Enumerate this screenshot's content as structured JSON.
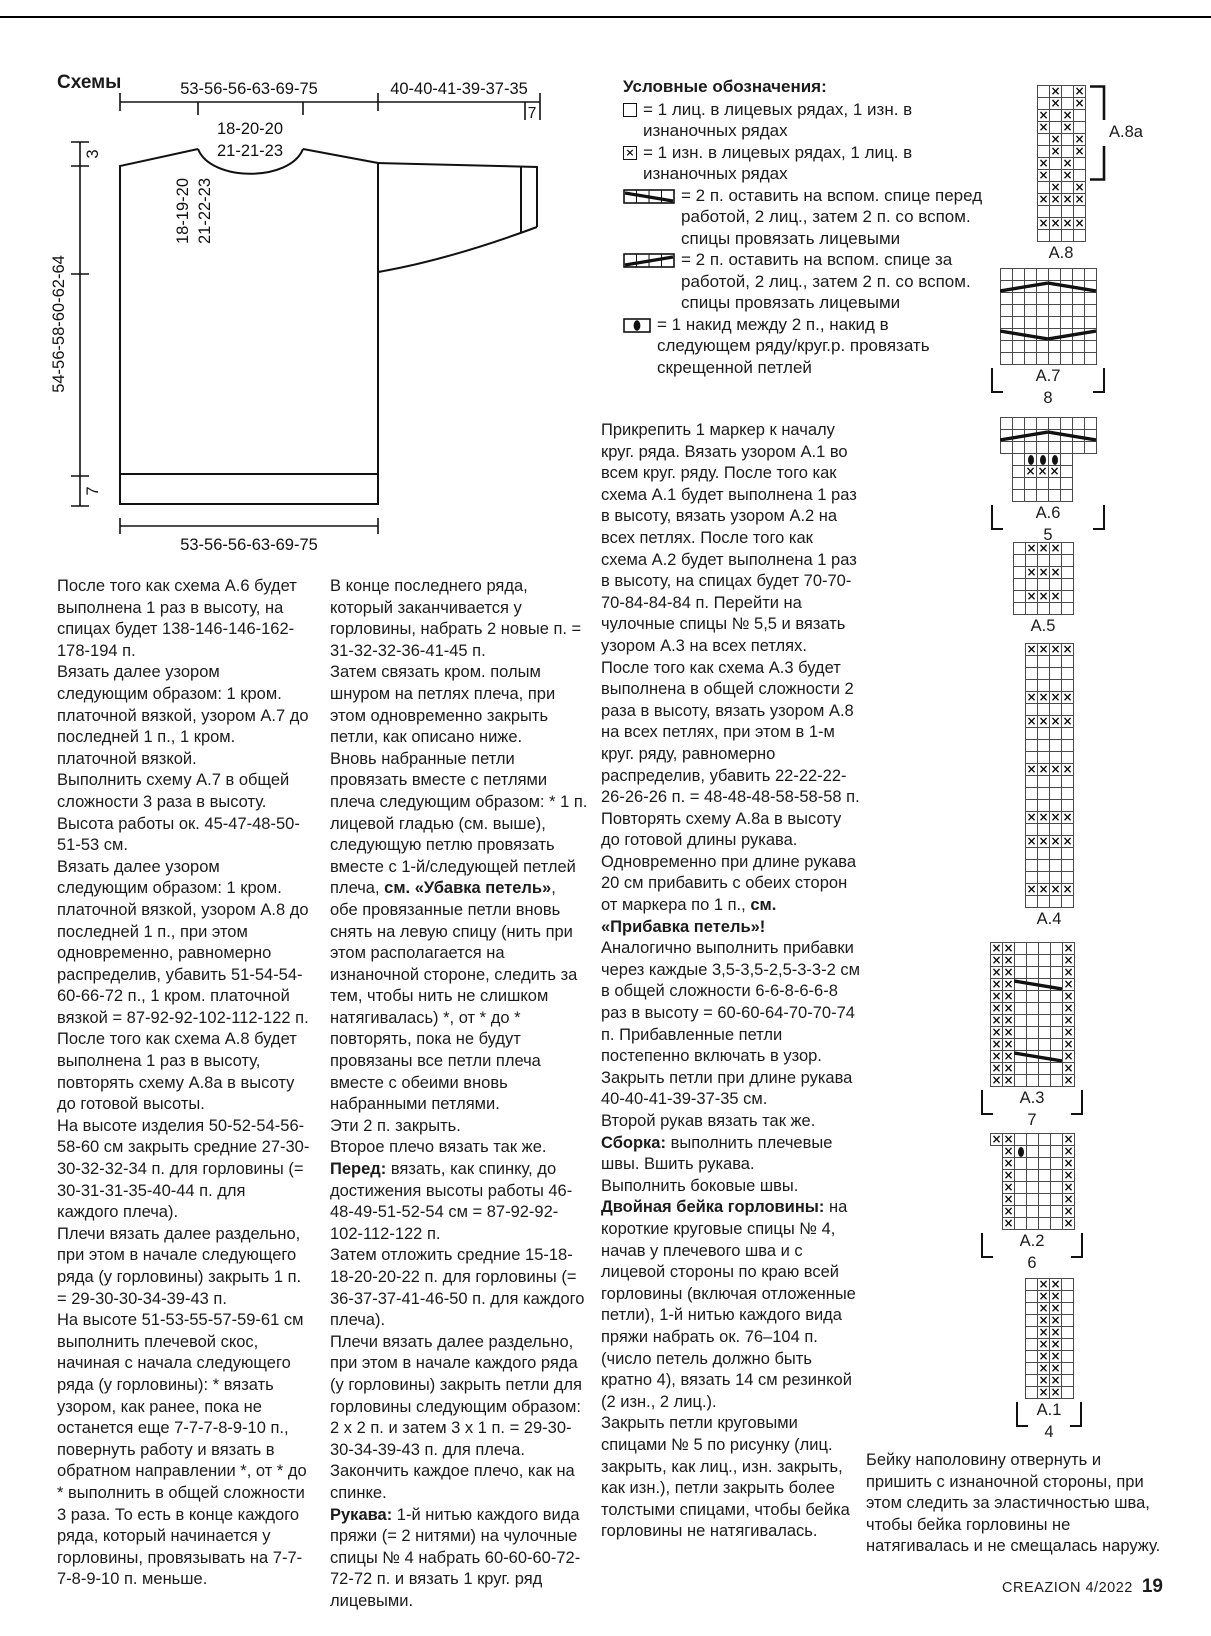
{
  "page": {
    "heading": "Схемы",
    "footer_magazine": "CREAZION 4/2022",
    "footer_page": "19"
  },
  "schematic": {
    "top_width": "53-56-56-63-69-75",
    "sleeve_length": "40-40-41-39-37-35",
    "cuff_width": "7",
    "neck_line1": "18-20-20",
    "neck_line2": "21-21-23",
    "shoulder_drop": "3",
    "yoke_line1": "18-19-20",
    "yoke_line2": "21-22-23",
    "side_height": "54-56-58-60-62-64",
    "rib_height": "7",
    "bottom_width": "53-56-56-63-69-75"
  },
  "legend": {
    "title": "Условные обозначения:",
    "items": [
      {
        "symbol": "knit-square",
        "text": "= 1 лиц. в лицевых рядах, 1 изн. в изнаночных рядах"
      },
      {
        "symbol": "purl-square-x",
        "text": "= 1 изн. в лицевых рядах, 1 лиц. в изнаночных рядах"
      },
      {
        "symbol": "cable-front-4",
        "text": "= 2 п. оставить на вспом. спице перед работой, 2 лиц., затем 2 п. со вспом. спицы провязать лицевыми"
      },
      {
        "symbol": "cable-back-4",
        "text": "= 2 п. оставить на вспом. спице за работой, 2 лиц., затем 2 п. со вспом. спицы провязать лицевыми"
      },
      {
        "symbol": "yarn-over-oval",
        "text": "= 1 накид между 2 п., накид в следующем ряду/круг.р. провязать скрещенной петлей"
      }
    ]
  },
  "charts": [
    {
      "id": "A.8",
      "cols": 4,
      "label": "A.8",
      "num": "",
      "bracket": false,
      "rows": [
        ".x.x",
        ".x.x",
        "x.x.",
        "x.x.",
        ".x.x",
        ".x.x",
        "x.x.",
        "x.x.",
        ".x.x",
        "xxxx",
        "....",
        "xxxx",
        "...."
      ],
      "cables": [],
      "rbracket": {
        "label": "A.8a",
        "from": 1,
        "to": 8
      }
    },
    {
      "id": "A.7",
      "cols": 8,
      "label": "A.7",
      "num": "8",
      "bracket": true,
      "rows": [
        "........",
        "........",
        "........",
        "........",
        "........",
        "........",
        "........",
        "........"
      ],
      "cables": [
        {
          "r": 2,
          "c1": 1,
          "c2": 4,
          "dir": "up"
        },
        {
          "r": 2,
          "c1": 5,
          "c2": 8,
          "dir": "down"
        },
        {
          "r": 6,
          "c1": 1,
          "c2": 4,
          "dir": "down"
        },
        {
          "r": 6,
          "c1": 5,
          "c2": 8,
          "dir": "up"
        }
      ]
    },
    {
      "id": "A.6",
      "cols": 8,
      "label": "A.6",
      "num": "5",
      "bracket": true,
      "rows": [
        "........",
        "........",
        "........",
        "-.ooo.--",
        "-.xxx.--",
        "-.....--",
        "-.....--"
      ],
      "cables": [
        {
          "r": 2,
          "c1": 1,
          "c2": 4,
          "dir": "up"
        },
        {
          "r": 2,
          "c1": 5,
          "c2": 8,
          "dir": "down"
        }
      ]
    },
    {
      "id": "A.5",
      "cols": 5,
      "label": "A.5",
      "num": "",
      "bracket": false,
      "rows": [
        ".xxx.",
        ".....",
        ".xxx.",
        ".....",
        ".xxx.",
        "....."
      ],
      "cables": []
    },
    {
      "id": "A.4",
      "cols": 4,
      "label": "A.4",
      "num": "",
      "bracket": false,
      "rows": [
        "xxxx",
        "....",
        "....",
        "....",
        "xxxx",
        "....",
        "xxxx",
        "....",
        "....",
        "....",
        "xxxx",
        "....",
        "....",
        "....",
        "xxxx",
        "....",
        "xxxx",
        "....",
        "....",
        "....",
        "xxxx",
        "...."
      ],
      "cables": []
    },
    {
      "id": "A.3",
      "cols": 7,
      "label": "A.3",
      "num": "7",
      "bracket": true,
      "rows": [
        "xx....x",
        "xx....x",
        "xx....x",
        "xx....x",
        "xx....x",
        "xx....x",
        "xx....x",
        "xx....x",
        "xx....x",
        "xx....x",
        "xx....x",
        "xx....x"
      ],
      "cables": [
        {
          "r": 4,
          "c1": 3,
          "c2": 6,
          "dir": "down"
        },
        {
          "r": 10,
          "c1": 3,
          "c2": 6,
          "dir": "down"
        }
      ]
    },
    {
      "id": "A.2",
      "cols": 7,
      "label": "A.2",
      "num": "6",
      "bracket": true,
      "rows": [
        "xx....x",
        "-xo...x",
        "-x....x",
        "-x....x",
        "-x....x",
        "-x....x",
        "-x....x",
        "-x....x"
      ],
      "cables": []
    },
    {
      "id": "A.1",
      "cols": 4,
      "label": "A.1",
      "num": "4",
      "bracket": true,
      "rows": [
        ".xx.",
        ".xx.",
        ".xx.",
        ".xx.",
        ".xx.",
        ".xx.",
        ".xx.",
        ".xx.",
        ".xx.",
        ".xx."
      ],
      "cables": []
    }
  ],
  "columns": {
    "left": [
      [
        {
          "t": "После того как схема А.6 будет выполнена 1 раз в высоту, на спицах будет 138-146-146-162-178-194 п."
        }
      ],
      [
        {
          "t": "Вязать далее узором следующим образом: 1 кром. платочной вязкой, узором А.7 до последней 1 п., 1 кром. платочной вязкой."
        }
      ],
      [
        {
          "t": "Выполнить схему А.7 в общей сложности 3 раза в высоту. Высота работы ок. 45-47-48-50-51-53 см."
        }
      ],
      [
        {
          "t": "Вязать далее узором следующим образом: 1 кром. платочной вязкой, узором А.8 до последней 1 п., при этом одновременно, равномерно распределив, убавить 51-54-54-60-66-72 п., 1 кром. платочной вязкой = 87-92-92-102-112-122 п."
        }
      ],
      [
        {
          "t": "После того как схема А.8 будет выполнена 1 раз в высоту, повторять схему А.8а в высоту до готовой высоты."
        }
      ],
      [
        {
          "t": "На высоте изделия 50-52-54-56-58-60 см закрыть средние 27-30-30-32-32-34 п. для горловины (= 30-31-31-35-40-44 п. для каждого плеча)."
        }
      ],
      [
        {
          "t": "Плечи вязать далее раздельно, при этом в начале следующего ряда (у горловины) закрыть 1 п. = 29-30-30-34-39-43 п."
        }
      ],
      [
        {
          "t": "На высоте 51-53-55-57-59-61 см выполнить плечевой скос, начиная с начала следующего ряда (у горловины): * вязать узором, как ранее, пока не останется еще 7-7-7-8-9-10 п., повернуть работу и вязать в обратном направлении *, от * до * выполнить в общей сложности 3 раза. То есть в конце каждого ряда, который начинается у горловины, провязывать на 7-7-7-8-9-10 п. меньше."
        }
      ]
    ],
    "middle": [
      [
        {
          "t": "В конце последнего ряда, который заканчивается у горловины, набрать 2 новые п. = 31-32-32-36-41-45 п."
        }
      ],
      [
        {
          "t": "Затем связать кром. полым шнуром на петлях плеча, при этом одновременно закрыть петли, как описано ниже."
        }
      ],
      [
        {
          "t": "Вновь набранные петли провязать вместе с петлями плеча следующим образом: * 1 п. лицевой гладью (см. выше), следующую петлю провязать вместе с 1-й/следующей петлей плеча, "
        },
        {
          "t": "см. «Убавка петель»",
          "b": true
        },
        {
          "t": ", обе провязанные петли вновь снять на левую спицу (нить при этом располагается на изнаночной стороне, следить за тем, чтобы нить не слишком натягивалась) *, от * до * повторять, пока не будут провязаны все петли плеча вместе с обеими вновь набранными петлями."
        }
      ],
      [
        {
          "t": "Эти 2 п. закрыть."
        }
      ],
      [
        {
          "t": "Второе плечо вязать так же."
        }
      ],
      [
        {
          "t": "Перед:",
          "b": true
        },
        {
          "t": " вязать, как спинку, до достижения высоты работы 46-48-49-51-52-54 см = 87-92-92-102-112-122 п."
        }
      ],
      [
        {
          "t": "Затем отложить средние 15-18-18-20-20-22 п. для горловины (= 36-37-37-41-46-50 п. для каждого плеча)."
        }
      ],
      [
        {
          "t": "Плечи вязать далее раздельно, при этом в начале каждого ряда (у горловины) закрыть петли для горловины следующим образом: 2 х 2 п. и затем 3 х 1 п. = 29-30-30-34-39-43 п. для плеча."
        }
      ],
      [
        {
          "t": "Закончить каждое плечо, как на спинке."
        }
      ],
      [
        {
          "t": "Рукава:",
          "b": true
        },
        {
          "t": " 1-й нитью каждого вида пряжи (= 2 нитями) на чулочные спицы № 4 набрать 60-60-60-72-72-72 п. и вязать 1 круг. ряд лицевыми."
        }
      ]
    ],
    "right": [
      [
        {
          "t": "Прикрепить 1 маркер к началу круг. ряда. Вязать узором А.1 во всем круг. ряду. После того как схема А.1 будет выполнена 1 раз в высоту, вязать узором А.2 на всех петлях. После того как схема А.2 будет выполнена 1 раз в высоту, на спицах будет 70-70-70-84-84-84 п. Перейти на чулочные спицы № 5,5 и вязать узором А.3 на всех петлях."
        }
      ],
      [
        {
          "t": "После того как схема А.3 будет выполнена в общей сложности 2 раза в высоту, вязать узором А.8 на всех петлях, при этом в 1-м круг. ряду, равномерно распределив, убавить 22-22-22-26-26-26 п. = 48-48-48-58-58-58 п."
        }
      ],
      [
        {
          "t": "Повторять схему А.8а в высоту до готовой длины рукава."
        }
      ],
      [
        {
          "t": "Одновременно при длине рукава 20 см прибавить с обеих сторон от маркера по 1 п., "
        },
        {
          "t": "см. «Прибавка петель»!",
          "b": true
        }
      ],
      [
        {
          "t": "Аналогично выполнить прибавки через каждые 3,5-3,5-2,5-3-3-2 см в общей сложности 6-6-8-6-6-8 раз в высоту = 60-60-64-70-70-74 п. Прибавленные петли постепенно включать в узор."
        }
      ],
      [
        {
          "t": "Закрыть петли при длине рукава 40-40-41-39-37-35 см."
        }
      ],
      [
        {
          "t": "Второй рукав вязать так же."
        }
      ],
      [
        {
          "t": "Сборка:",
          "b": true
        },
        {
          "t": " выполнить плечевые швы. Вшить рукава."
        }
      ],
      [
        {
          "t": "Выполнить боковые швы."
        }
      ],
      [
        {
          "t": "Двойная бейка горловины:",
          "b": true
        },
        {
          "t": " на короткие круговые спицы № 4, начав у плечевого шва и с лицевой стороны по краю всей горловины (включая отложенные петли), 1-й нитью каждого вида пряжи набрать ок. 76–104 п. (число петель должно быть кратно 4), вязать 14 см резинкой (2 изн., 2 лиц.)."
        }
      ],
      [
        {
          "t": "Закрыть петли круговыми спицами № 5 по рисунку (лиц. закрыть, как лиц., изн. закрыть, как изн.), петли закрыть более толстыми спицами, чтобы бейка горловины не натягивалась."
        }
      ]
    ]
  },
  "closing_note": "Бейку наполовину отвернуть и пришить с изнаночной стороны, при этом следить за эластичностью шва, чтобы бейка горловины не натягивалась и не смещалась наружу."
}
